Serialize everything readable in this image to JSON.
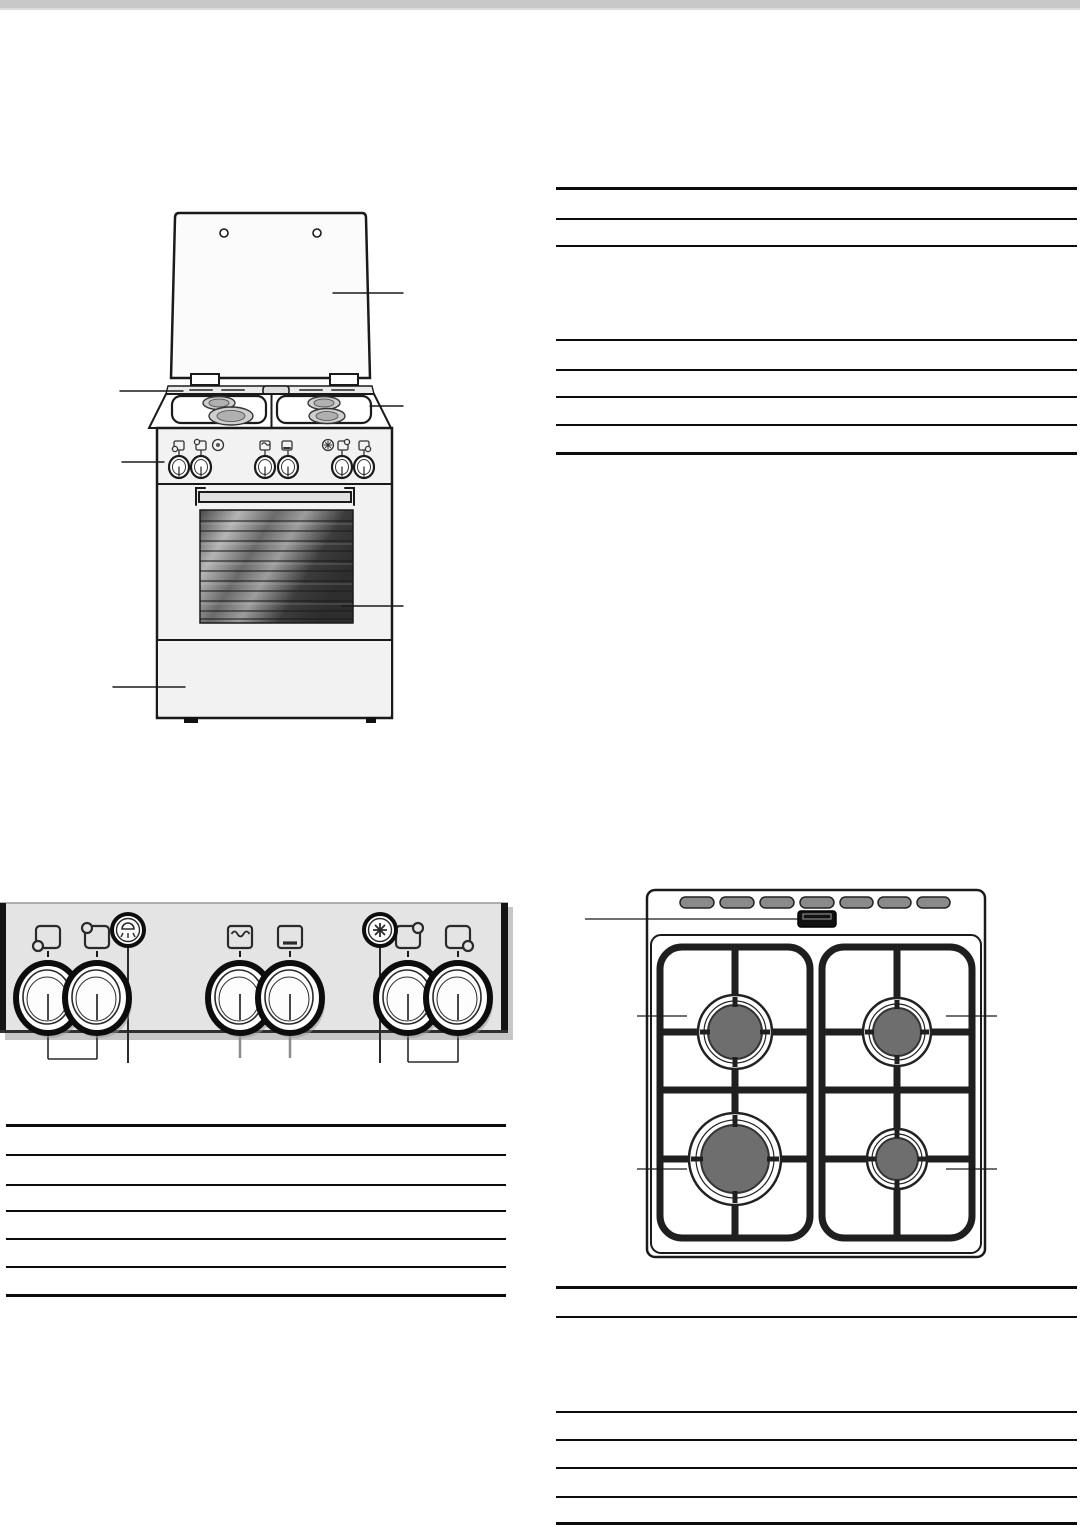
{
  "page": {
    "width": 1080,
    "height": 1525,
    "background": "#ffffff",
    "header_bar": {
      "height": 8,
      "color": "#c8c8c8"
    }
  },
  "colors": {
    "rule_line": "#0c0c0c",
    "line_art": "#1a1a1a",
    "panel_fill": "#e4e4e4",
    "panel_shadow": "#c6c6c6",
    "burner_cap": "#6e6e6e",
    "vent_slot": "#8a8a8a",
    "oven_glass_dark": "#3a3a3a",
    "oven_glass_light": "#b5b5b5",
    "body_fill": "#f2f2f2"
  },
  "figures": {
    "cooker_front_view": {
      "id": "figure-cooker",
      "callouts": [
        "hob-cover-lid",
        "hotplate-left",
        "hotplate-frame-right",
        "control-panel",
        "oven-window",
        "storage-drawer"
      ]
    },
    "control_panel": {
      "id": "figure-control-panel",
      "icons": [
        "burner-rear-left-icon",
        "burner-front-left-icon",
        "oven-light-button-icon",
        "grill-icon",
        "bottom-heat-icon",
        "ignition-star-icon",
        "burner-rear-right-icon",
        "burner-front-right-icon"
      ],
      "knob_count": 6,
      "callout_groups": [
        "left-burner-knobs",
        "oven-light",
        "grill-knob",
        "oven-knob",
        "ignition-button",
        "right-burner-knobs"
      ]
    },
    "hob_top_view": {
      "id": "figure-hob",
      "burners": [
        "rear-left-standard",
        "rear-right-standard",
        "front-left-wok-large",
        "front-right-economy-small"
      ],
      "vent_slot_count": 7,
      "callouts": [
        "igniter-box",
        "rear-left-burner",
        "rear-right-burner",
        "front-left-burner",
        "front-right-burner"
      ]
    }
  },
  "tables": [
    {
      "id": "table-top-right",
      "x": 556,
      "width": 521,
      "empty_rows": 7,
      "rules": [
        {
          "y": 187,
          "w": 3
        },
        {
          "y": 218,
          "w": 1.5
        },
        {
          "y": 245,
          "w": 1.5
        },
        {
          "y": 339,
          "w": 1.5
        },
        {
          "y": 369,
          "w": 1.5
        },
        {
          "y": 396,
          "w": 1.5
        },
        {
          "y": 424,
          "w": 1.5
        },
        {
          "y": 452,
          "w": 3
        }
      ]
    },
    {
      "id": "table-left",
      "x": 6,
      "width": 500,
      "empty_rows": 6,
      "rules": [
        {
          "y": 1124,
          "w": 3
        },
        {
          "y": 1154,
          "w": 1.5
        },
        {
          "y": 1184,
          "w": 1.5
        },
        {
          "y": 1210,
          "w": 1.5
        },
        {
          "y": 1238,
          "w": 1.5
        },
        {
          "y": 1266,
          "w": 1.5
        },
        {
          "y": 1294,
          "w": 3
        }
      ]
    },
    {
      "id": "table-bottom-right",
      "x": 556,
      "width": 521,
      "empty_rows": 6,
      "rules": [
        {
          "y": 1286,
          "w": 3
        },
        {
          "y": 1316,
          "w": 1.5
        },
        {
          "y": 1411,
          "w": 1.5
        },
        {
          "y": 1439,
          "w": 1.5
        },
        {
          "y": 1467,
          "w": 1.5
        },
        {
          "y": 1496,
          "w": 1.5
        },
        {
          "y": 1522,
          "w": 2.5
        }
      ]
    }
  ]
}
